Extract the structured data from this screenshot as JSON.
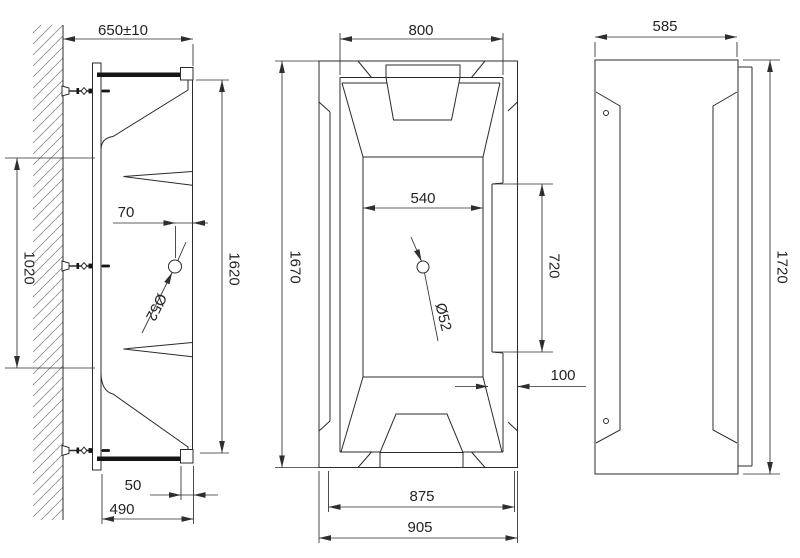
{
  "page": {
    "background": "#ffffff",
    "line_color": "#2b2b2b",
    "description": "Bathtub installation technical drawing, three orthographic views"
  },
  "views": {
    "side": {
      "name": "wall-mounted side section view",
      "dims": {
        "depth_overall": "650±10",
        "mount_span": "1020",
        "drain_offset": "70",
        "drain_diameter": "Ø52",
        "height_overall": "1620",
        "rim_edge": "50",
        "base_depth": "490"
      }
    },
    "plan": {
      "name": "top plan view",
      "dims": {
        "rim_opening_width": "800",
        "length_overall": "1670",
        "floor_width": "540",
        "drain_diameter": "Ø52",
        "deck_length": "720",
        "deck_width": "100",
        "base_width": "875",
        "width_overall": "905"
      }
    },
    "end": {
      "name": "end elevation view",
      "dims": {
        "width": "585",
        "length_overall": "1720"
      }
    }
  }
}
